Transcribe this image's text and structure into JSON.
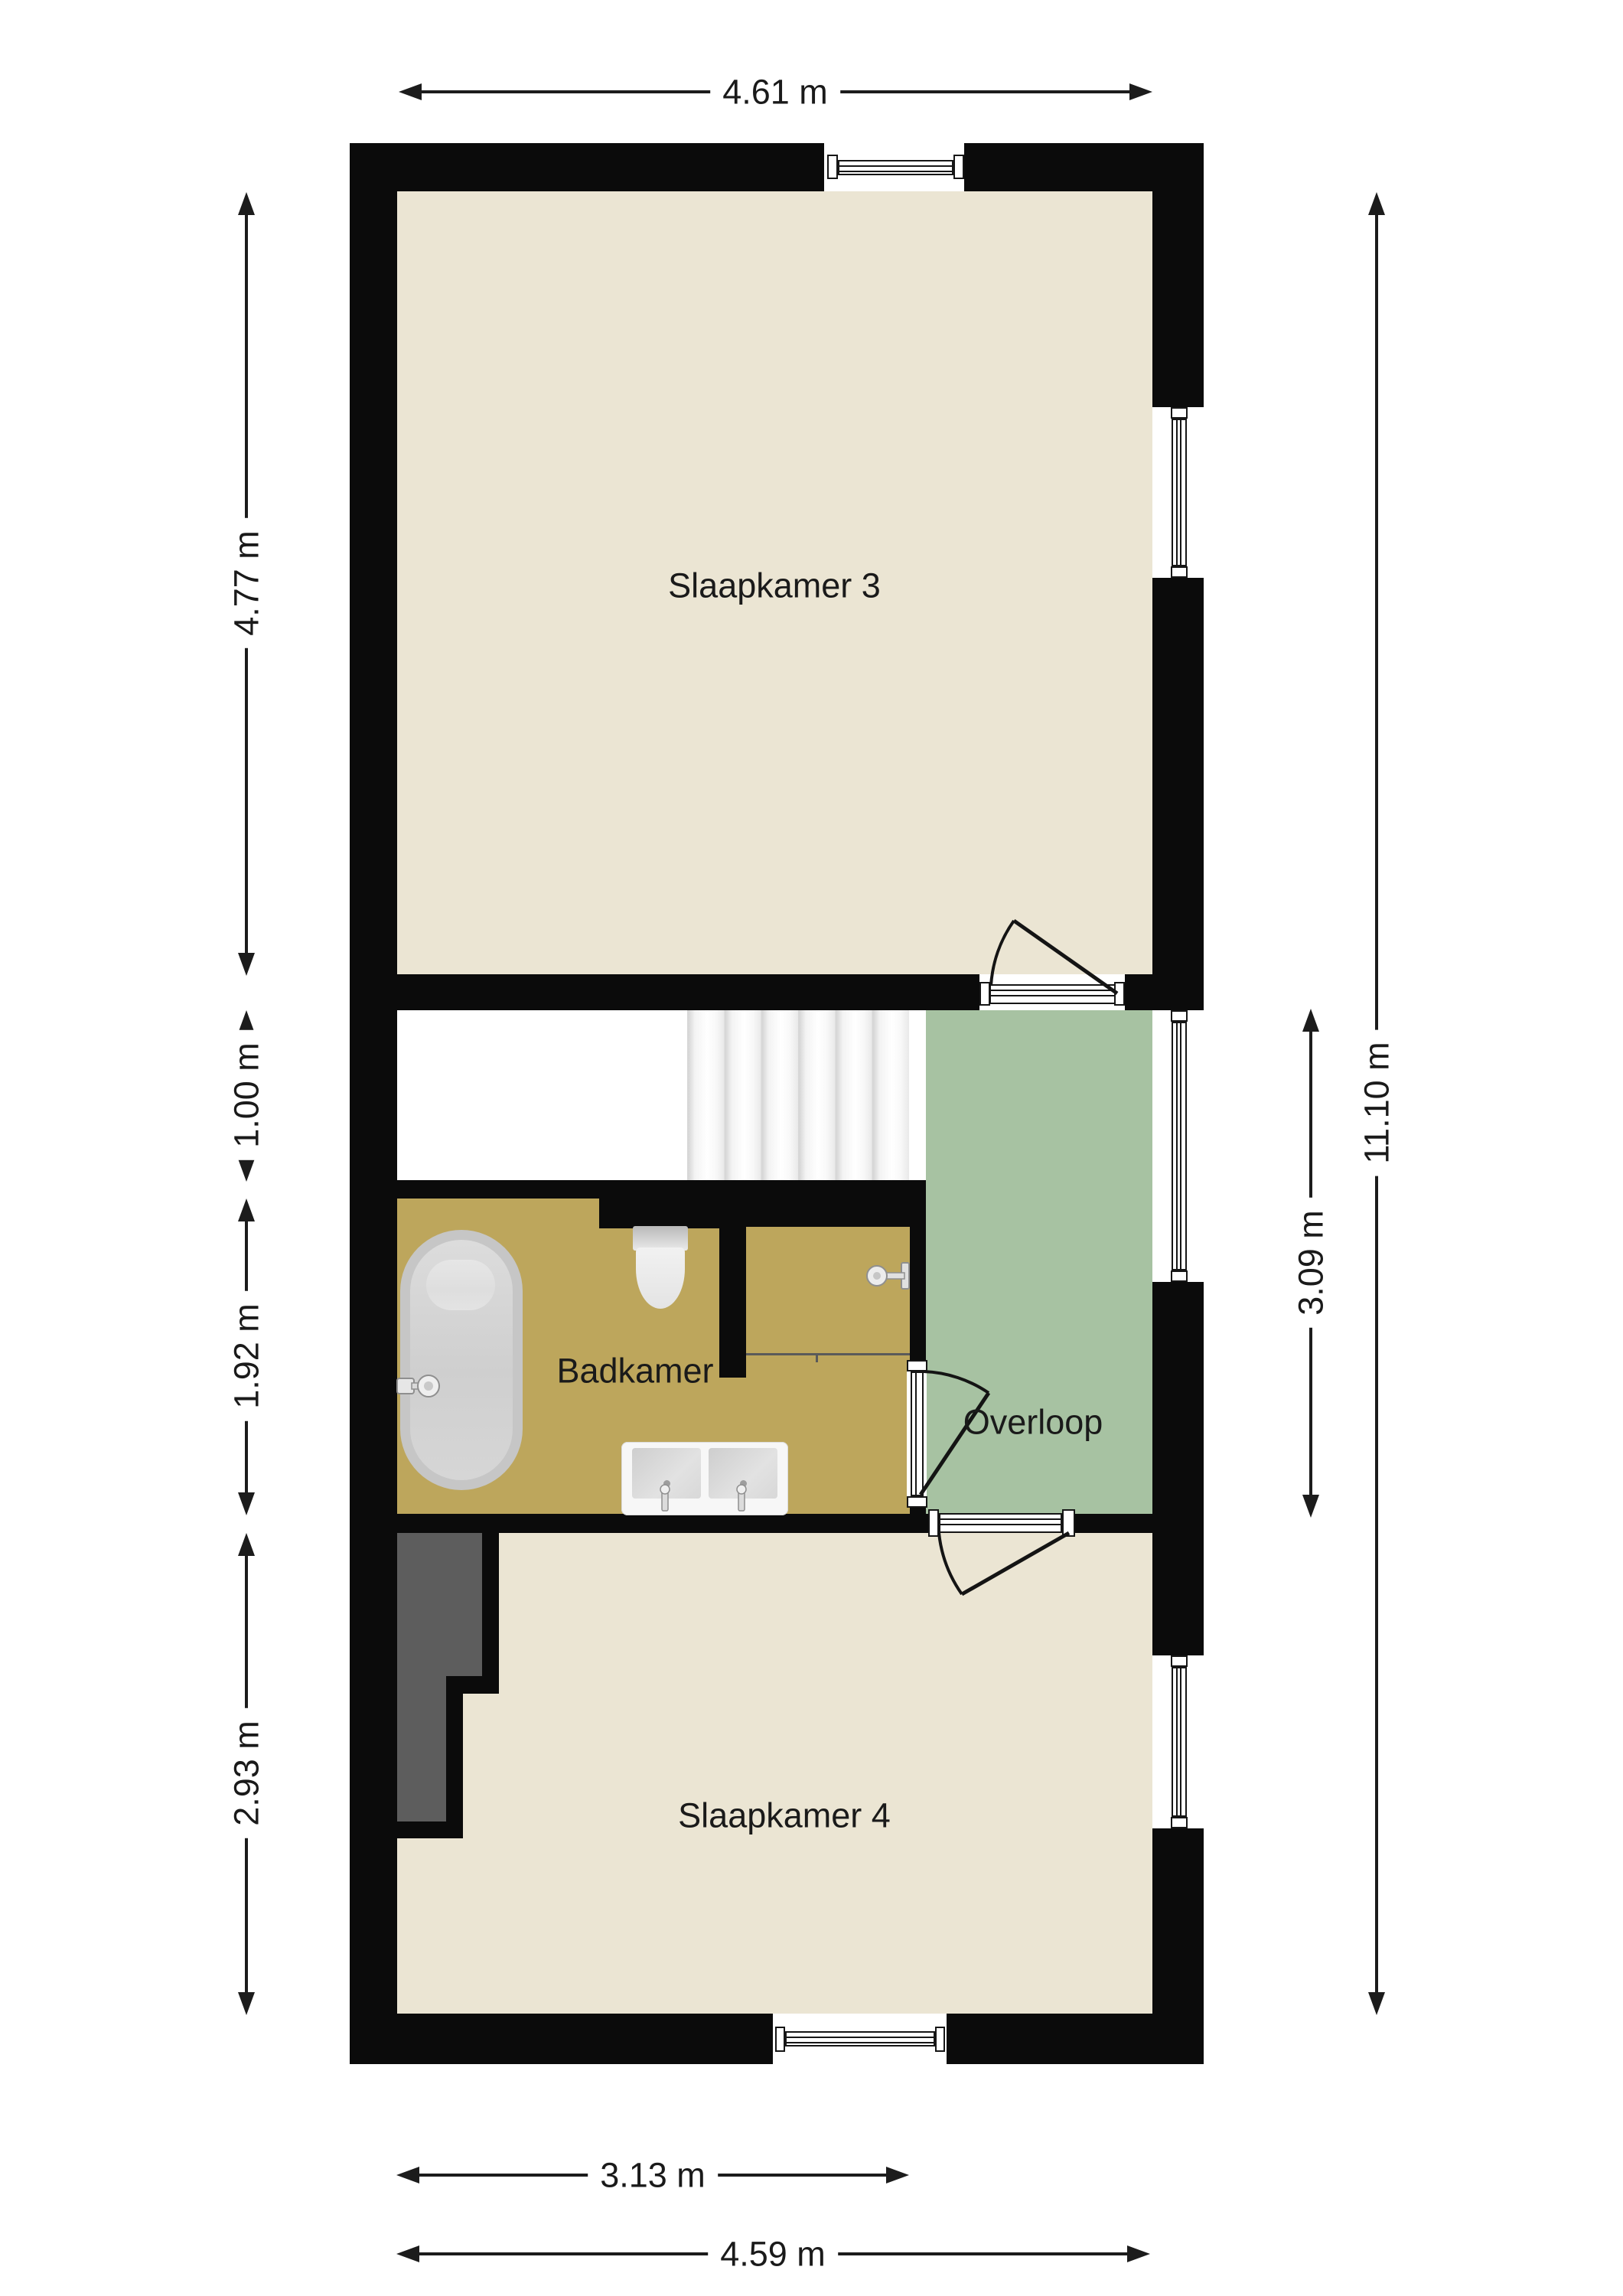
{
  "rooms": {
    "slaapkamer3": {
      "label": "Slaapkamer 3"
    },
    "badkamer": {
      "label": "Badkamer"
    },
    "overloop": {
      "label": "Overloop"
    },
    "slaapkamer4": {
      "label": "Slaapkamer 4"
    }
  },
  "dimensions": {
    "top_width": {
      "label": "4.61 m"
    },
    "sk3_height": {
      "label": "4.77 m"
    },
    "stairs_height": {
      "label": "1.00 m"
    },
    "badkamer_height": {
      "label": "1.92 m"
    },
    "sk4_height": {
      "label": "2.93 m"
    },
    "total_height": {
      "label": "11.10 m"
    },
    "overloop_height": {
      "label": "3.09 m"
    },
    "badkamer_width": {
      "label": "3.13 m"
    },
    "sk4_width": {
      "label": "4.59 m"
    }
  },
  "colors": {
    "wall": "#0b0b0b",
    "floor": "#ebe5d3",
    "bathroom": "#bda65c",
    "hall": "#a7c2a2",
    "closet": "#5d5d5d",
    "dim": "#1c1c1c",
    "text": "#1a1a1a"
  },
  "fixtures": {
    "bathtub": "bathtub",
    "toilet": "toilet",
    "double_sink": "double-sink-vanity",
    "shower": "shower-head",
    "stairs": "staircase"
  }
}
